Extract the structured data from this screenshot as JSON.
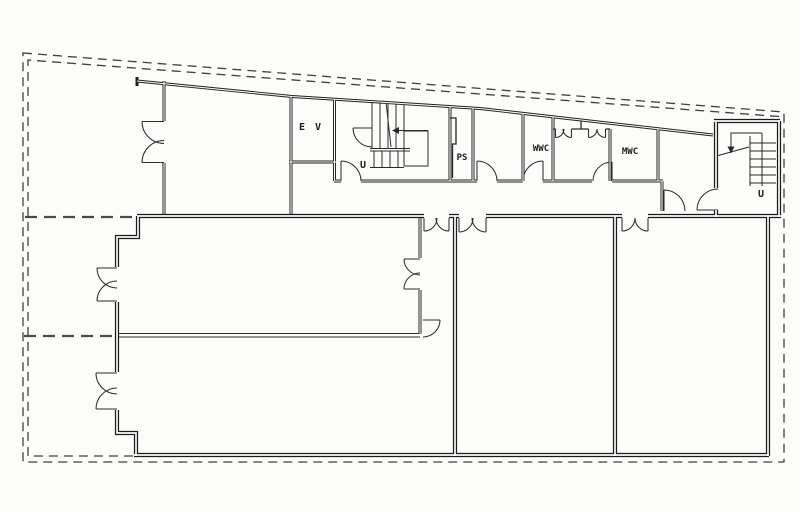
{
  "drawing": {
    "kind": "architectural floor plan (scanned line drawing)",
    "paper_color": "#fcfcfa",
    "ink_color": "#1f1f1f",
    "boundary_line_style": "dashed"
  },
  "rooms": [
    {
      "id": "elevator",
      "label": "E V"
    },
    {
      "id": "stairs-west",
      "label": "U"
    },
    {
      "id": "pipe-shaft",
      "label": "PS"
    },
    {
      "id": "womens-wc",
      "label": "WWC"
    },
    {
      "id": "mens-wc",
      "label": "MWC"
    },
    {
      "id": "stairs-east",
      "label": "U"
    }
  ]
}
